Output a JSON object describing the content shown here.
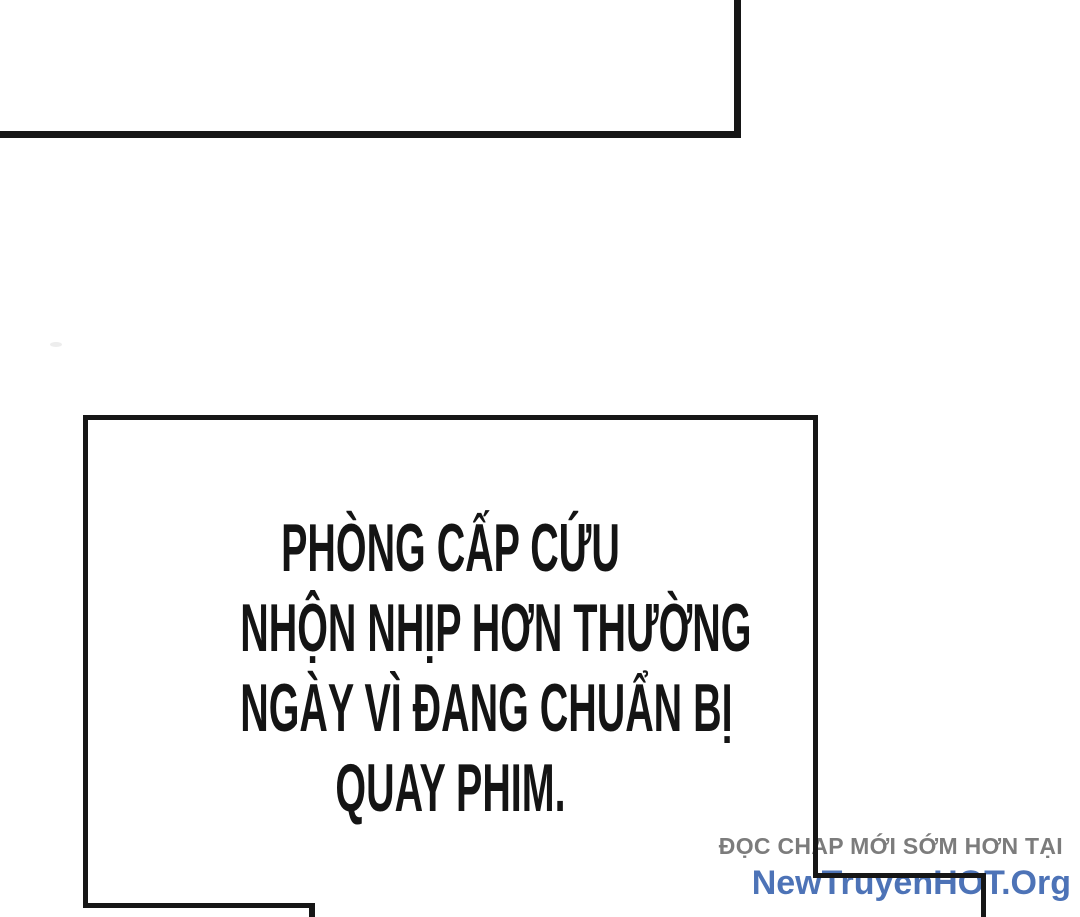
{
  "page": {
    "background": "#ffffff",
    "ink": "#161616"
  },
  "caption": {
    "text_color": "#141414",
    "lines": [
      "PHÒNG CẤP CỨU",
      "NHỘN NHỊP HƠN THƯỜNG",
      "NGÀY VÌ ĐANG CHUẨN BỊ",
      "QUAY PHIM."
    ]
  },
  "watermark": {
    "line1": "ĐỌC CHAP MỚI SỚM HƠN TẠI",
    "line1_color": "#7c7c7c",
    "line2": "NewTruyenHOT.Org",
    "line2_color": "#4d73b7"
  }
}
